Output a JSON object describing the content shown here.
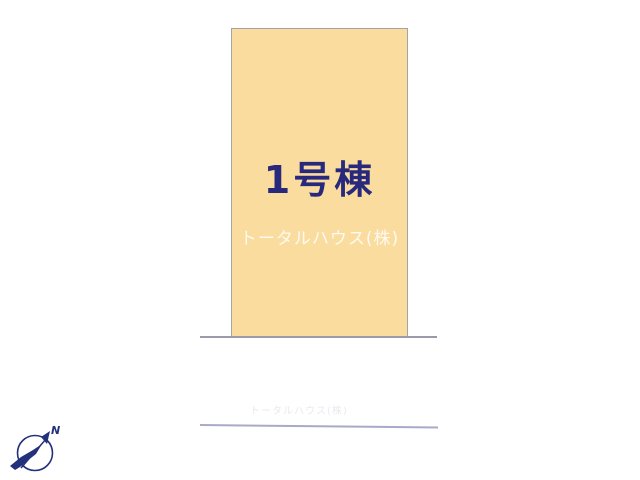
{
  "lot": {
    "label": "1号棟",
    "watermark": "トータルハウス(株)",
    "fill": "#F9DC9E",
    "border": "#A4A4A4",
    "label_color": "#28297D"
  },
  "ground": {
    "faint_watermark": "トータルハウス(株)"
  },
  "compass": {
    "north_label": "N",
    "color": "#23307C"
  }
}
